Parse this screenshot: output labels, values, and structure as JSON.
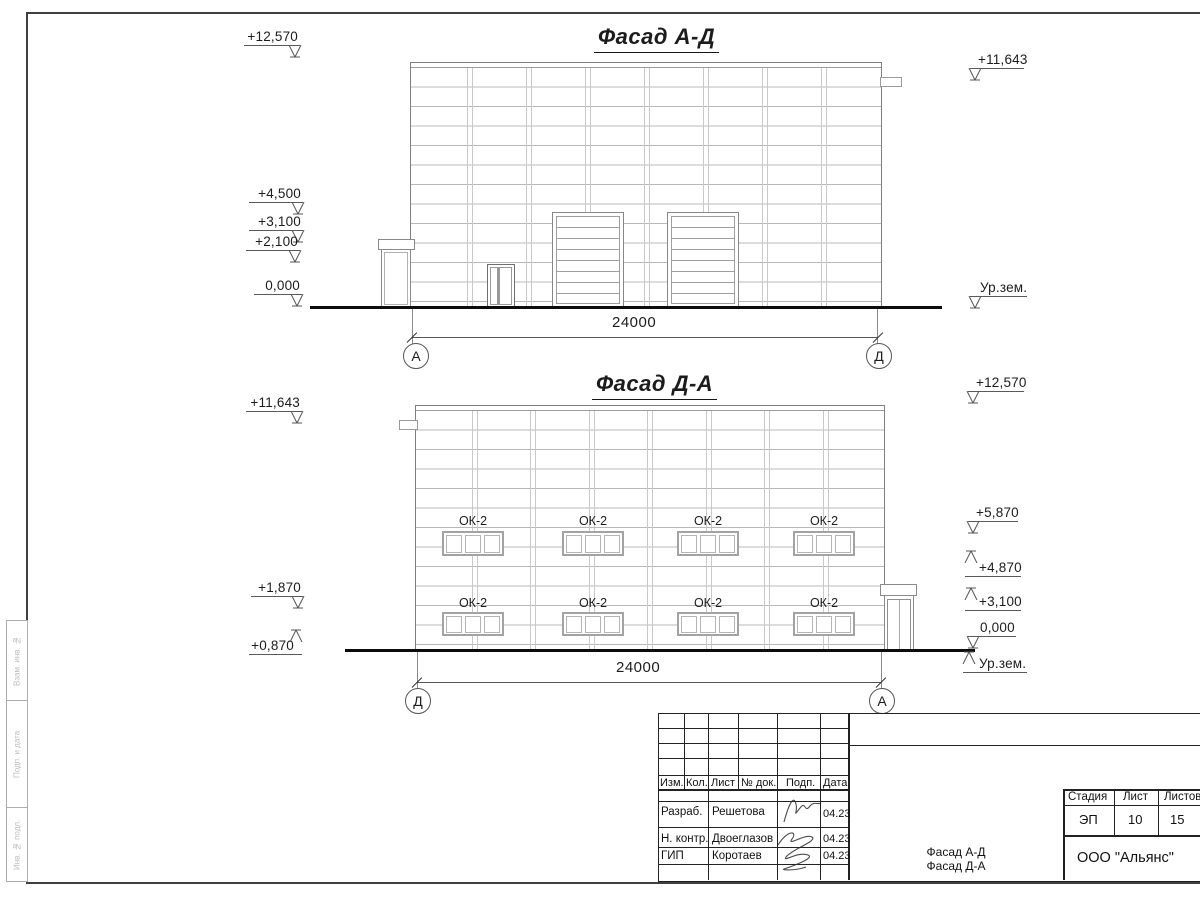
{
  "drawing": {
    "facade_ad": {
      "title": "Фасад А-Д",
      "dimension": "24000",
      "axis_left": "А",
      "axis_right": "Д",
      "levels_left": [
        "+12,570",
        "+4,500",
        "+3,100",
        "+2,100",
        "0,000"
      ],
      "levels_right": [
        "+11,643",
        "Ур.зем."
      ]
    },
    "facade_da": {
      "title": "Фасад Д-А",
      "dimension": "24000",
      "axis_left": "Д",
      "axis_right": "А",
      "window_label": "ОК-2",
      "levels_left": [
        "+11,643",
        "+1,870",
        "+0,870"
      ],
      "levels_right": [
        "+12,570",
        "+5,870",
        "+4,870",
        "+3,100",
        "0,000",
        "Ур.зем."
      ]
    }
  },
  "title_block": {
    "revision_headers": [
      "Изм.",
      "Кол.",
      "Лист",
      "№ док.",
      "Подп.",
      "Дата"
    ],
    "signoff_rows": [
      {
        "role": "Разраб.",
        "name": "Решетова",
        "date": "04.23"
      },
      {
        "role": "Н. контр.",
        "name": "Двоеглазов",
        "date": "04.23"
      },
      {
        "role": "ГИП",
        "name": "Коротаев",
        "date": "04.23"
      }
    ],
    "stage_header": "Стадия",
    "sheet_header": "Лист",
    "sheets_header": "Листов",
    "stage": "ЭП",
    "sheet_no": "10",
    "sheets_total": "15",
    "doc_title_line1": "Фасад А-Д",
    "doc_title_line2": "Фасад Д-А",
    "company": "ООО \"Альянс\""
  },
  "side_stamp": [
    "Взам. инв. №",
    "Подп. и дата",
    "Инв. № подл."
  ]
}
